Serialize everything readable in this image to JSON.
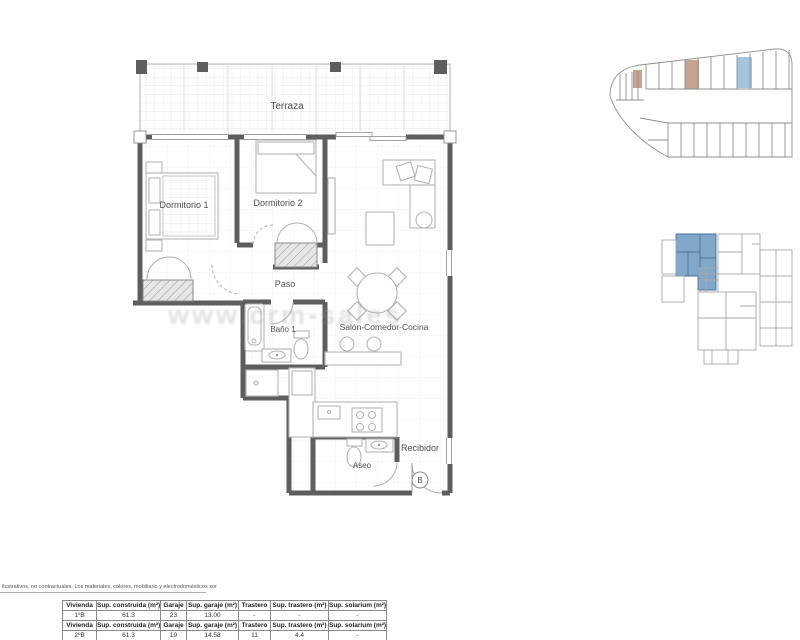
{
  "plan": {
    "rooms": {
      "terraza": "Terraza",
      "dormitorio1": "Dormitorio 1",
      "dormitorio2": "Dormitorio 2",
      "paso": "Paso",
      "bano1": "Baño 1",
      "salon": "Salón-Comedor-Cocina",
      "aseo": "Aseo",
      "recibidor": "Recibidor"
    },
    "entrance_letter": "B",
    "watermark": "www.crm-sales"
  },
  "colors": {
    "wall": "#5e5e5e",
    "furniture_line": "#b5b5b5",
    "floor_grid": "#ececec",
    "garage_highlight_beige": "#c4a391",
    "garage_highlight_blue": "#a3c6de",
    "keyplan_highlight_blue": "#7fa8cb"
  },
  "tables": [
    {
      "headers": [
        "Vivienda",
        "Sup. construida (m²)",
        "Garaje",
        "Sup. garaje (m²)",
        "Trastero",
        "Sup. trastero (m²)",
        "Sup. solarium (m²)"
      ],
      "row": [
        "1ºB",
        "61.3",
        "23",
        "13.00",
        "-",
        "-",
        "-"
      ]
    },
    {
      "headers": [
        "Vivienda",
        "Sup. construida (m²)",
        "Garaje",
        "Sup. garaje (m²)",
        "Trastero",
        "Sup. trastero (m²)",
        "Sup. solarium (m²)"
      ],
      "row": [
        "2ºB",
        "61.3",
        "19",
        "14.58",
        "11",
        "4.4",
        "-"
      ]
    }
  ],
  "disclaimer": "ilustrativos, no contractuales. Los materiales, colores, mobiliario y electrodomésticos son orientativos"
}
